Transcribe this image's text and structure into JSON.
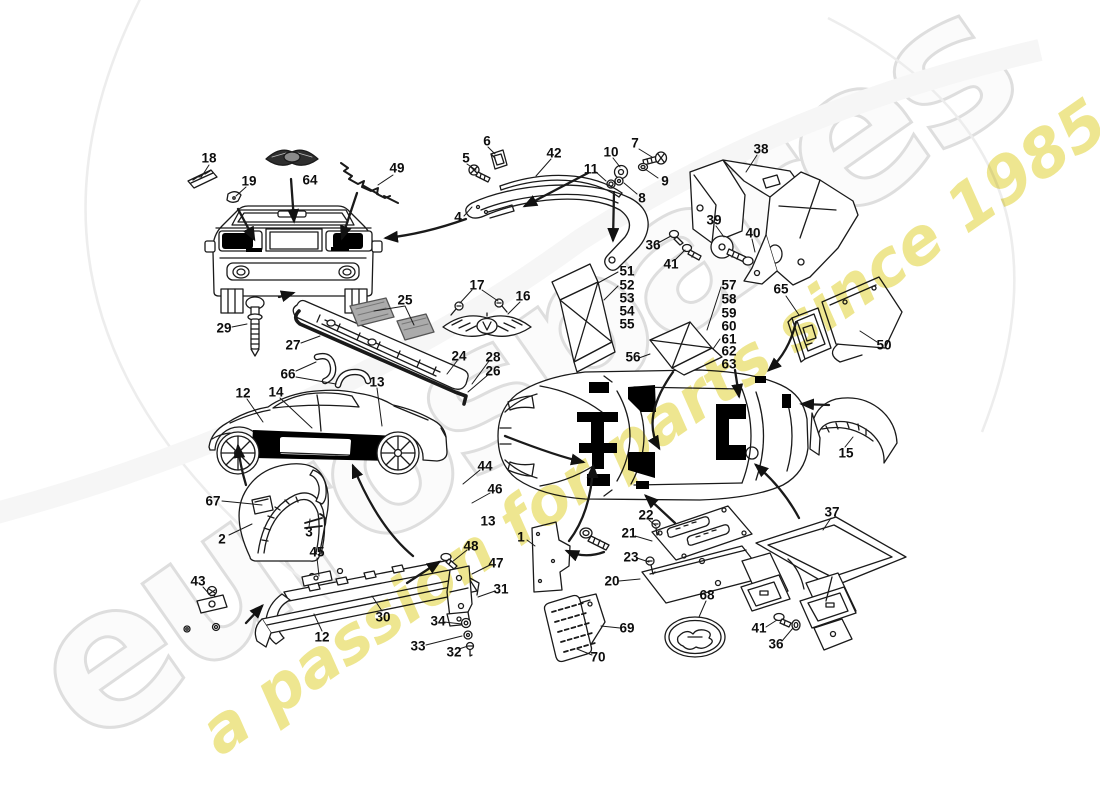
{
  "watermarks": {
    "brand": "eurospares",
    "tagline": "a passion for parts since 1985",
    "brand_color": "#dedede",
    "tagline_color": "#ece381"
  },
  "diagram": {
    "line_color": "#1a1a1a",
    "pad_color": "#000000",
    "shade_color": "#ababab"
  },
  "part_labels": [
    {
      "n": "18",
      "x": 209,
      "y": 158
    },
    {
      "n": "19",
      "x": 249,
      "y": 181
    },
    {
      "n": "64",
      "x": 310,
      "y": 180
    },
    {
      "n": "49",
      "x": 397,
      "y": 168
    },
    {
      "n": "5",
      "x": 466,
      "y": 158
    },
    {
      "n": "6",
      "x": 487,
      "y": 141
    },
    {
      "n": "42",
      "x": 554,
      "y": 153
    },
    {
      "n": "11",
      "x": 591,
      "y": 169
    },
    {
      "n": "10",
      "x": 611,
      "y": 152
    },
    {
      "n": "7",
      "x": 635,
      "y": 143
    },
    {
      "n": "9",
      "x": 665,
      "y": 181
    },
    {
      "n": "8",
      "x": 642,
      "y": 198
    },
    {
      "n": "38",
      "x": 761,
      "y": 149
    },
    {
      "n": "4",
      "x": 458,
      "y": 217
    },
    {
      "n": "36",
      "x": 653,
      "y": 245
    },
    {
      "n": "41",
      "x": 671,
      "y": 264
    },
    {
      "n": "39",
      "x": 714,
      "y": 220
    },
    {
      "n": "40",
      "x": 753,
      "y": 233
    },
    {
      "n": "29",
      "x": 224,
      "y": 328
    },
    {
      "n": "27",
      "x": 293,
      "y": 345
    },
    {
      "n": "25",
      "x": 405,
      "y": 300
    },
    {
      "n": "17",
      "x": 477,
      "y": 285
    },
    {
      "n": "16",
      "x": 523,
      "y": 296
    },
    {
      "n": "24",
      "x": 459,
      "y": 356
    },
    {
      "n": "28",
      "x": 493,
      "y": 357
    },
    {
      "n": "26",
      "x": 493,
      "y": 371
    },
    {
      "n": "51",
      "x": 627,
      "y": 271
    },
    {
      "n": "52",
      "x": 627,
      "y": 285
    },
    {
      "n": "53",
      "x": 627,
      "y": 298
    },
    {
      "n": "54",
      "x": 627,
      "y": 311
    },
    {
      "n": "55",
      "x": 627,
      "y": 324
    },
    {
      "n": "56",
      "x": 633,
      "y": 357
    },
    {
      "n": "57",
      "x": 729,
      "y": 285
    },
    {
      "n": "58",
      "x": 729,
      "y": 299
    },
    {
      "n": "59",
      "x": 729,
      "y": 313
    },
    {
      "n": "60",
      "x": 729,
      "y": 326
    },
    {
      "n": "61",
      "x": 729,
      "y": 339
    },
    {
      "n": "62",
      "x": 729,
      "y": 351
    },
    {
      "n": "63",
      "x": 729,
      "y": 364
    },
    {
      "n": "65",
      "x": 781,
      "y": 289
    },
    {
      "n": "50",
      "x": 884,
      "y": 345
    },
    {
      "n": "66",
      "x": 288,
      "y": 374
    },
    {
      "n": "13",
      "x": 377,
      "y": 382
    },
    {
      "n": "12",
      "x": 243,
      "y": 393
    },
    {
      "n": "14",
      "x": 276,
      "y": 392
    },
    {
      "n": "67",
      "x": 213,
      "y": 501
    },
    {
      "n": "2",
      "x": 222,
      "y": 539
    },
    {
      "n": "3",
      "x": 309,
      "y": 532
    },
    {
      "n": "44",
      "x": 485,
      "y": 466
    },
    {
      "n": "46",
      "x": 495,
      "y": 489
    },
    {
      "n": "13",
      "x": 488,
      "y": 521
    },
    {
      "n": "45",
      "x": 317,
      "y": 552
    },
    {
      "n": "48",
      "x": 471,
      "y": 546
    },
    {
      "n": "47",
      "x": 496,
      "y": 563
    },
    {
      "n": "31",
      "x": 501,
      "y": 589
    },
    {
      "n": "43",
      "x": 198,
      "y": 581
    },
    {
      "n": "30",
      "x": 383,
      "y": 617
    },
    {
      "n": "12",
      "x": 322,
      "y": 637
    },
    {
      "n": "34",
      "x": 438,
      "y": 621
    },
    {
      "n": "33",
      "x": 418,
      "y": 646
    },
    {
      "n": "32",
      "x": 454,
      "y": 652
    },
    {
      "n": "1",
      "x": 521,
      "y": 537
    },
    {
      "n": "22",
      "x": 646,
      "y": 515
    },
    {
      "n": "21",
      "x": 629,
      "y": 533
    },
    {
      "n": "23",
      "x": 631,
      "y": 557
    },
    {
      "n": "20",
      "x": 612,
      "y": 581
    },
    {
      "n": "68",
      "x": 707,
      "y": 595
    },
    {
      "n": "69",
      "x": 627,
      "y": 628
    },
    {
      "n": "70",
      "x": 598,
      "y": 657
    },
    {
      "n": "41",
      "x": 759,
      "y": 628
    },
    {
      "n": "36",
      "x": 776,
      "y": 644
    },
    {
      "n": "15",
      "x": 846,
      "y": 453
    },
    {
      "n": "37",
      "x": 832,
      "y": 512
    }
  ]
}
